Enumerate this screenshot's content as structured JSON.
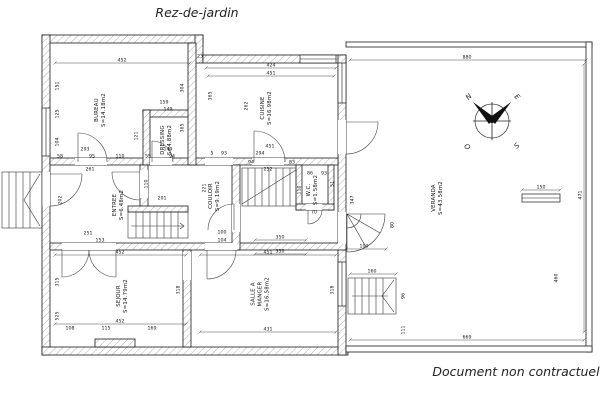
{
  "page": {
    "title": "Rez-de-jardin",
    "footer": "Document non contractuel"
  },
  "compass": {
    "points": [
      {
        "label": "N",
        "x": 469,
        "y": 97,
        "rot": -45
      },
      {
        "label": "E",
        "x": 517,
        "y": 97,
        "rot": 45
      },
      {
        "label": "O",
        "x": 467,
        "y": 147,
        "rot": 45
      },
      {
        "label": "S",
        "x": 517,
        "y": 146,
        "rot": -45
      }
    ]
  },
  "plan": {
    "rooms": [
      {
        "id": "bureau",
        "x": 100,
        "y": 110,
        "lines": [
          "BUREAU",
          "S=14.18m2"
        ]
      },
      {
        "id": "dressing",
        "x": 166,
        "y": 140,
        "lines": [
          "DRESSING",
          "S=4.88m2"
        ]
      },
      {
        "id": "cuisine",
        "x": 266,
        "y": 108,
        "lines": [
          "CUISINE",
          "S=16.98m2"
        ]
      },
      {
        "id": "entree",
        "x": 118,
        "y": 205,
        "lines": [
          "ENTREE",
          "S=6.48m2"
        ]
      },
      {
        "id": "couloir",
        "x": 214,
        "y": 196,
        "lines": [
          "COULOIR",
          "S=9.19m2"
        ]
      },
      {
        "id": "wc",
        "x": 312,
        "y": 190,
        "lines": [
          "W.C.",
          "S=1.58m2"
        ]
      },
      {
        "id": "sejour",
        "x": 122,
        "y": 296,
        "lines": [
          "SEJOUR",
          "S=14.79m2"
        ]
      },
      {
        "id": "salle-a-manger",
        "x": 260,
        "y": 294,
        "lines": [
          "SALLE A",
          "MANGER",
          "S=16.58m2"
        ]
      },
      {
        "id": "veranda",
        "x": 437,
        "y": 198,
        "lines": [
          "VERANDA",
          "S=43.58m2"
        ]
      }
    ],
    "dimensions": [
      {
        "t": "452",
        "x": 122,
        "y": 60,
        "l": [
          55,
          63,
          190,
          63
        ]
      },
      {
        "t": "23",
        "x": 200,
        "y": 56
      },
      {
        "t": "424",
        "x": 271,
        "y": 65,
        "l": [
          206,
          68,
          336,
          68
        ]
      },
      {
        "t": "451",
        "x": 271,
        "y": 73,
        "l": [
          208,
          76,
          334,
          76
        ]
      },
      {
        "t": "880",
        "x": 467,
        "y": 57,
        "l": [
          350,
          60,
          586,
          60
        ]
      },
      {
        "t": "151",
        "x": 57,
        "y": 86,
        "r": -90
      },
      {
        "t": "125",
        "x": 57,
        "y": 114,
        "r": -90
      },
      {
        "t": "104",
        "x": 57,
        "y": 142,
        "r": -90
      },
      {
        "t": "293",
        "x": 85,
        "y": 149
      },
      {
        "t": "58",
        "x": 60,
        "y": 156
      },
      {
        "t": "95",
        "x": 92,
        "y": 156
      },
      {
        "t": "110",
        "x": 120,
        "y": 156
      },
      {
        "t": "304",
        "x": 182,
        "y": 88,
        "r": -90
      },
      {
        "t": "365",
        "x": 182,
        "y": 128,
        "r": -90
      },
      {
        "t": "159",
        "x": 164,
        "y": 102
      },
      {
        "t": "149",
        "x": 168,
        "y": 109
      },
      {
        "t": "121",
        "x": 136,
        "y": 136,
        "r": -90
      },
      {
        "t": "149",
        "x": 168,
        "y": 149
      },
      {
        "t": "55",
        "x": 148,
        "y": 156
      },
      {
        "t": "94",
        "x": 172,
        "y": 156
      },
      {
        "t": "365",
        "x": 210,
        "y": 96,
        "r": -90
      },
      {
        "t": "262",
        "x": 246,
        "y": 106,
        "r": -90
      },
      {
        "t": "451",
        "x": 270,
        "y": 146
      },
      {
        "t": "294",
        "x": 260,
        "y": 153
      },
      {
        "t": "5",
        "x": 212,
        "y": 153
      },
      {
        "t": "93",
        "x": 224,
        "y": 153
      },
      {
        "t": "252",
        "x": 268,
        "y": 169
      },
      {
        "t": "94",
        "x": 251,
        "y": 162
      },
      {
        "t": "83",
        "x": 292,
        "y": 162
      },
      {
        "t": "261",
        "x": 90,
        "y": 169
      },
      {
        "t": "110",
        "x": 146,
        "y": 184,
        "r": -90
      },
      {
        "t": "202",
        "x": 60,
        "y": 200,
        "r": -90
      },
      {
        "t": "153",
        "x": 100,
        "y": 240
      },
      {
        "t": "251",
        "x": 88,
        "y": 233
      },
      {
        "t": "201",
        "x": 162,
        "y": 198
      },
      {
        "t": "221",
        "x": 204,
        "y": 188,
        "r": -90
      },
      {
        "t": "100",
        "x": 222,
        "y": 232
      },
      {
        "t": "104",
        "x": 222,
        "y": 240
      },
      {
        "t": "86",
        "x": 310,
        "y": 173
      },
      {
        "t": "93",
        "x": 324,
        "y": 173
      },
      {
        "t": "110",
        "x": 299,
        "y": 190,
        "r": -90
      },
      {
        "t": "51",
        "x": 332,
        "y": 184,
        "r": -90
      },
      {
        "t": "70",
        "x": 314,
        "y": 212
      },
      {
        "t": "350",
        "x": 280,
        "y": 237,
        "l": [
          255,
          240,
          306,
          240
        ]
      },
      {
        "t": "350",
        "x": 280,
        "y": 251,
        "l": [
          255,
          254,
          306,
          254
        ]
      },
      {
        "t": "452",
        "x": 120,
        "y": 252,
        "l": [
          55,
          255,
          186,
          255
        ]
      },
      {
        "t": "451",
        "x": 268,
        "y": 252,
        "l": [
          200,
          255,
          336,
          255
        ]
      },
      {
        "t": "315",
        "x": 57,
        "y": 282,
        "r": -90
      },
      {
        "t": "525",
        "x": 57,
        "y": 316,
        "r": -90
      },
      {
        "t": "318",
        "x": 178,
        "y": 290,
        "r": -90
      },
      {
        "t": "452",
        "x": 120,
        "y": 321,
        "l": [
          55,
          324,
          186,
          324
        ]
      },
      {
        "t": "108",
        "x": 70,
        "y": 328
      },
      {
        "t": "115",
        "x": 106,
        "y": 328
      },
      {
        "t": "169",
        "x": 152,
        "y": 328
      },
      {
        "t": "431",
        "x": 268,
        "y": 329,
        "l": [
          200,
          332,
          336,
          332
        ]
      },
      {
        "t": "318",
        "x": 332,
        "y": 290,
        "r": -90
      },
      {
        "t": "347",
        "x": 352,
        "y": 200,
        "r": -90
      },
      {
        "t": "471",
        "x": 580,
        "y": 195,
        "r": -90,
        "l": [
          584,
          64,
          584,
          332
        ]
      },
      {
        "t": "150",
        "x": 541,
        "y": 187,
        "l": [
          522,
          190,
          560,
          190
        ]
      },
      {
        "t": "100",
        "x": 364,
        "y": 246,
        "l": [
          346,
          249,
          386,
          249
        ]
      },
      {
        "t": "80",
        "x": 392,
        "y": 225,
        "r": -90
      },
      {
        "t": "160",
        "x": 372,
        "y": 271,
        "l": [
          350,
          274,
          396,
          274
        ]
      },
      {
        "t": "96",
        "x": 403,
        "y": 296,
        "r": -90
      },
      {
        "t": "111",
        "x": 403,
        "y": 330,
        "r": -90
      },
      {
        "t": "460",
        "x": 556,
        "y": 278,
        "r": -90
      },
      {
        "t": "669",
        "x": 467,
        "y": 337,
        "l": [
          350,
          340,
          584,
          340
        ]
      }
    ]
  }
}
